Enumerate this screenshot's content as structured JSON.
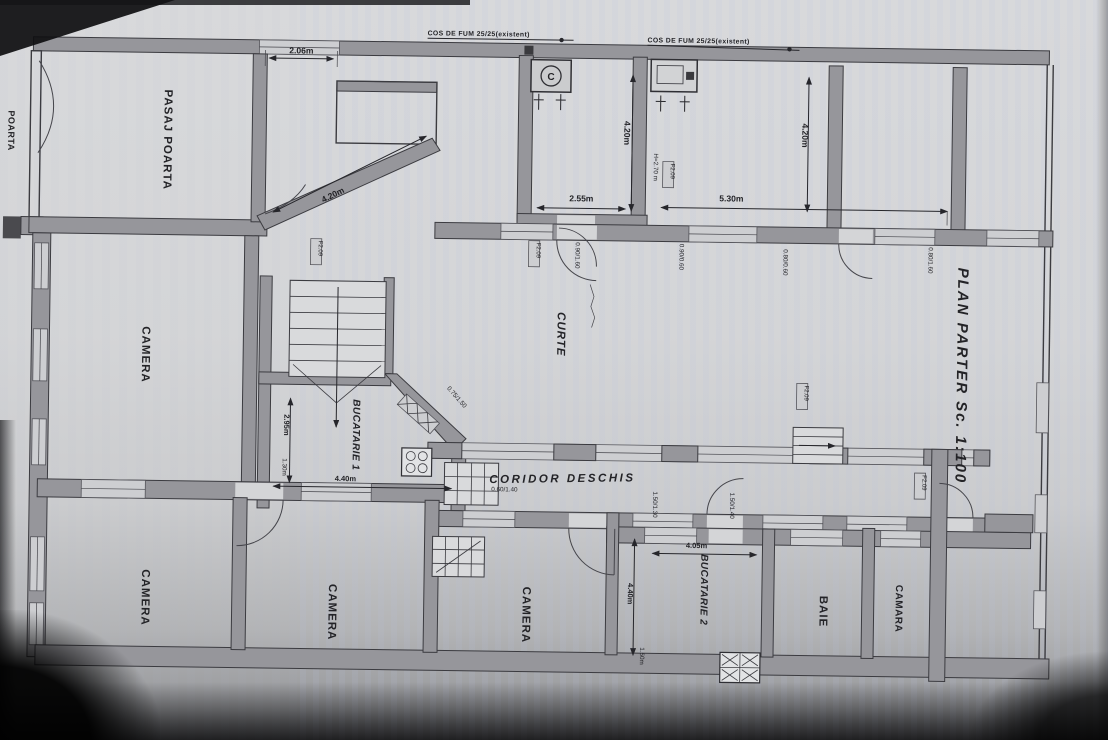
{
  "plan": {
    "title": "PLAN PARTER Sc. 1:100",
    "notes": {
      "chimney_left": "COS DE FUM 25/25(existent)",
      "chimney_right": "COS DE FUM 25/25(existent)"
    },
    "rooms": {
      "pasaj": "PASAJ POARTA",
      "poarta": "POARTA",
      "camera1": "CAMERA",
      "camera2": "CAMERA",
      "camera3": "CAMERA",
      "camera4": "CAMERA",
      "bucatarie1": "BUCATARIE 1",
      "bucatarie2": "BUCATARIE 2",
      "baie": "BAIE",
      "camara": "CAMARA",
      "curte": "CURTE",
      "coridor": "CORIDOR DESCHIS"
    },
    "dims": {
      "d206": "2.06m",
      "d420diag": "4.20m",
      "d420a": "4.20m",
      "d255": "2.55m",
      "d530": "5.30m",
      "d420b": "4.20m",
      "h270": "H=2.70 m",
      "d295": "2.95m",
      "d130": "1.30m",
      "d440a": "4.40m",
      "step": "0.60/1.40",
      "d405": "4.05m",
      "d440b": "4.40m",
      "d150": "1.50m",
      "dw1": "0.90/1.60",
      "dw2": "0.90/0.60",
      "dw3": "0.80/0.60",
      "dw4": "0.80/1.60",
      "dw5": "1.50/1.30",
      "dw6": "1.50/1.40",
      "dw7": "0.75/1.50"
    },
    "tags": [
      "F2.09",
      "F2.09",
      "F2.09",
      "F2.09",
      "F2.09"
    ],
    "symbols": {
      "boiler": "C"
    },
    "colors": {
      "paper": "#d4d5d7",
      "wall": "#96969b",
      "line": "#2f2f34",
      "window": "#cdced1"
    }
  }
}
